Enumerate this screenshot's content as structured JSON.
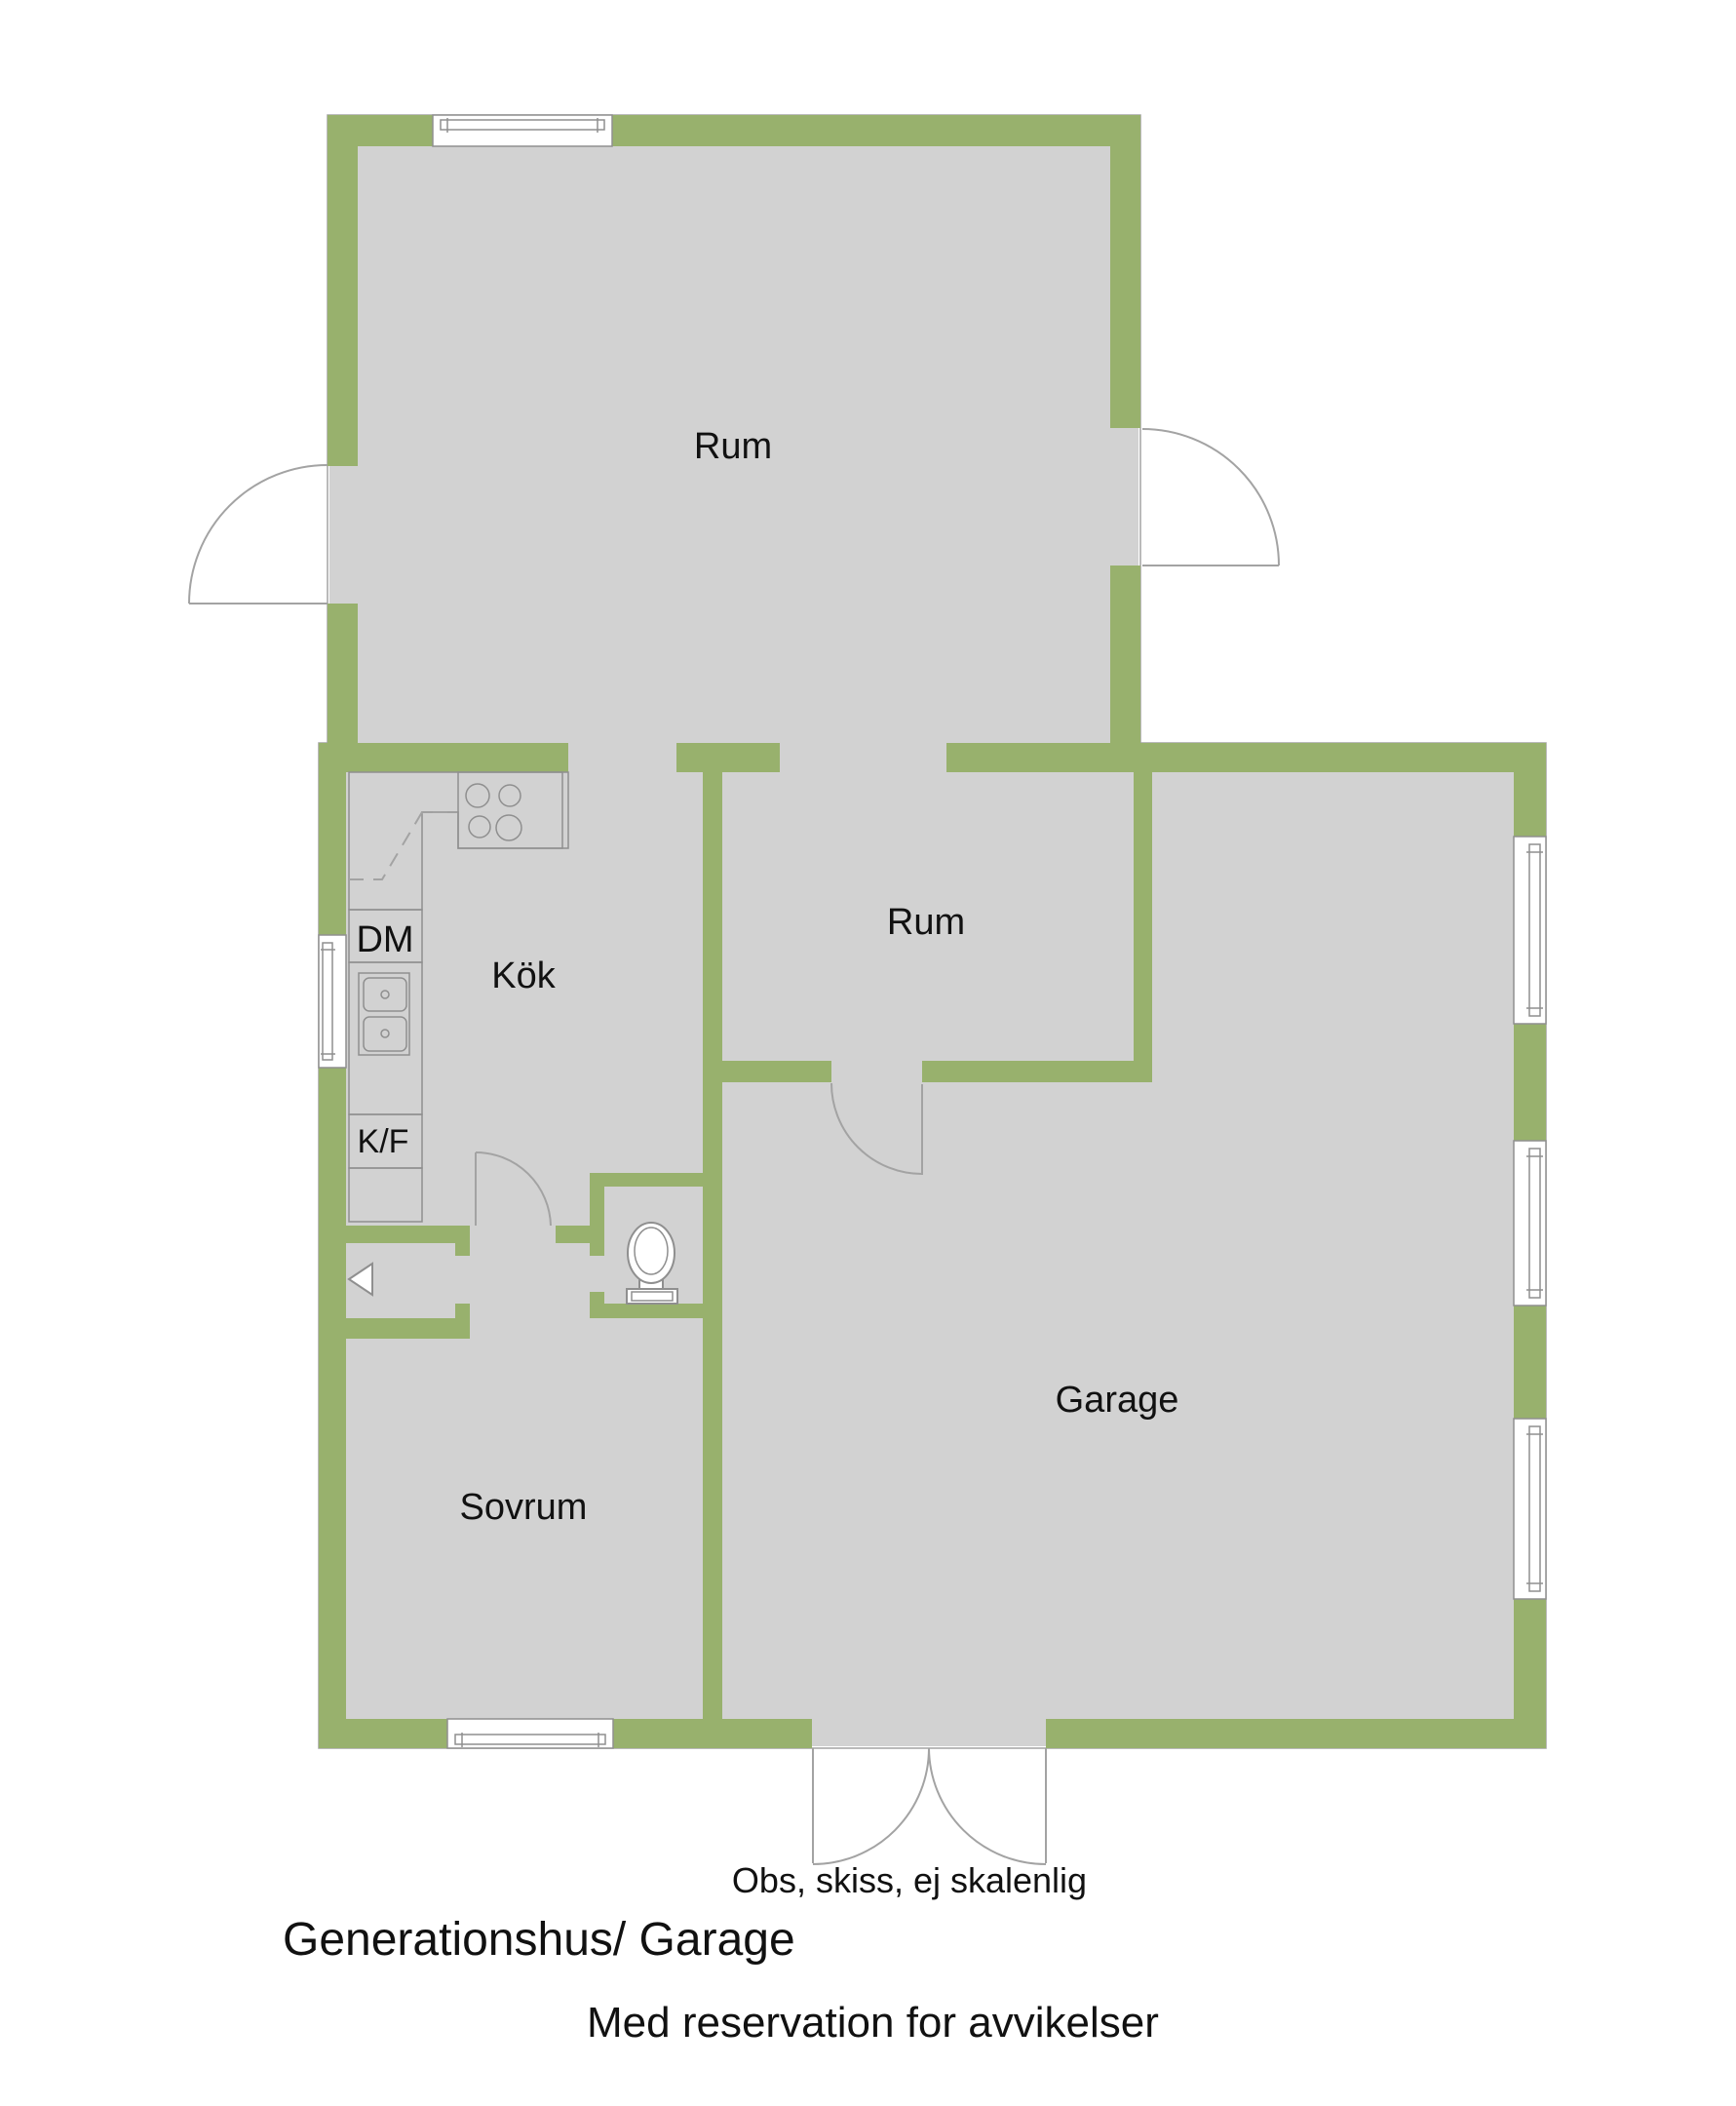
{
  "rooms": {
    "rum_top": "Rum",
    "rum_mid": "Rum",
    "kitchen": "Kök",
    "bedroom": "Sovrum",
    "garage": "Garage"
  },
  "appliances": {
    "dishwasher": "DM",
    "fridge_freezer": "K/F"
  },
  "notes": {
    "sketch_disclaimer": "Obs, skiss, ej skalenlig",
    "plan_title": "Generationshus/ Garage",
    "reservation": "Med reservation for avvikelser"
  },
  "icons": [
    "window-icon",
    "door-arc-icon",
    "stove-icon",
    "sink-icon",
    "toilet-icon",
    "entrance-arrow-icon",
    "garage-door-icon"
  ],
  "colors": {
    "wall": "#98b16d",
    "floor": "#d2d2d2",
    "outline": "#a3a3a3",
    "fixture_line": "#8f8f8f",
    "text": "#111111",
    "background": "#ffffff"
  }
}
